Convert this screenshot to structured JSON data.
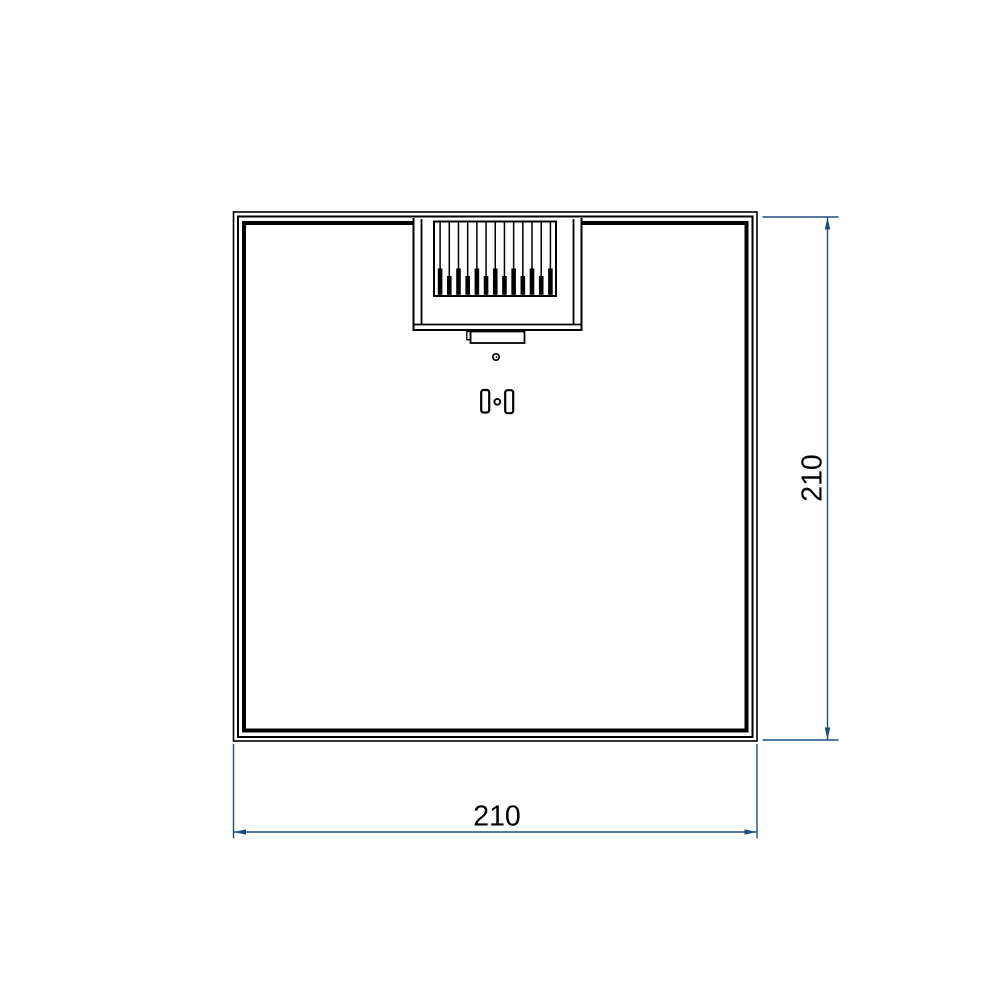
{
  "drawing": {
    "type": "technical-drawing",
    "view": "square-panel-rear-view",
    "dimension_width": {
      "label": "210"
    },
    "dimension_height": {
      "label": "210"
    }
  },
  "connector": {
    "pin_count": 13
  },
  "colors": {
    "line": "#000000",
    "dimension": "#1F4E79",
    "text": "#000000",
    "background": "#FFFFFF"
  }
}
